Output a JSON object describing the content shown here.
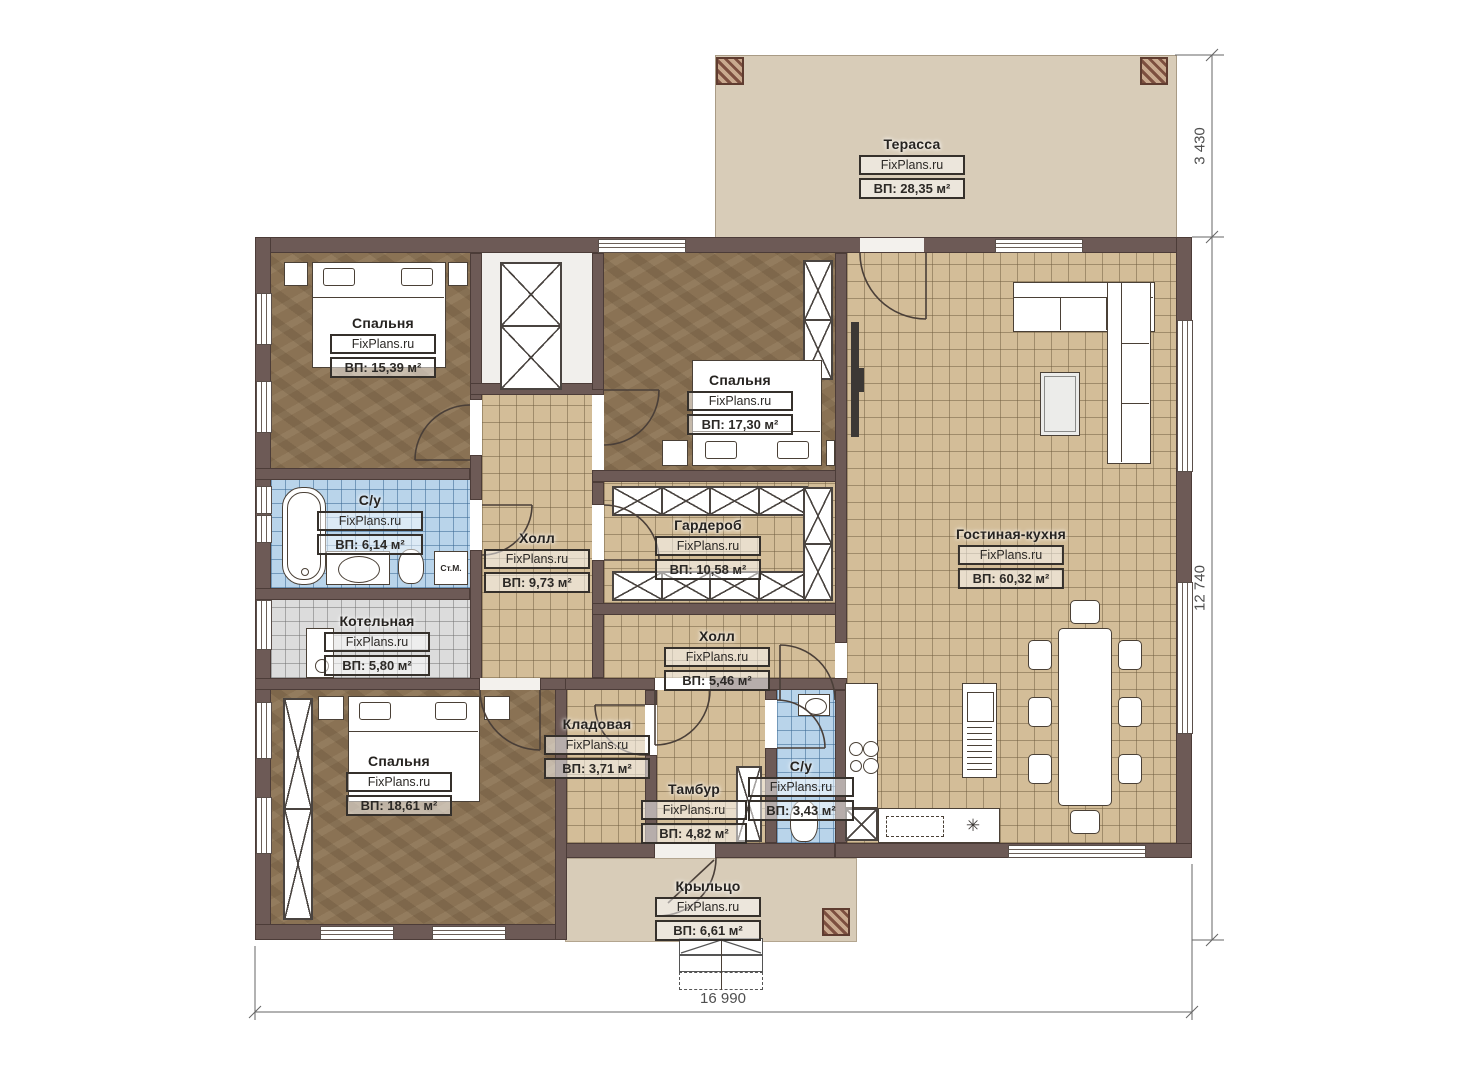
{
  "brand": "FixPlans.ru",
  "rooms": [
    {
      "id": "terrace",
      "name": "Терасса",
      "area": "ВП: 28,35 м²"
    },
    {
      "id": "bedroom-1",
      "name": "Спальня",
      "area": "ВП: 15,39 м²"
    },
    {
      "id": "bedroom-2",
      "name": "Спальня",
      "area": "ВП: 17,30 м²"
    },
    {
      "id": "bathroom-1",
      "name": "С/у",
      "area": "ВП: 6,14 м²"
    },
    {
      "id": "hall-1",
      "name": "Холл",
      "area": "ВП: 9,73 м²"
    },
    {
      "id": "wardrobe",
      "name": "Гардероб",
      "area": "ВП: 10,58 м²"
    },
    {
      "id": "living-kitchen",
      "name": "Гостиная-кухня",
      "area": "ВП: 60,32 м²"
    },
    {
      "id": "boiler-room",
      "name": "Котельная",
      "area": "ВП: 5,80 м²"
    },
    {
      "id": "hall-2",
      "name": "Холл",
      "area": "ВП: 5,46 м²"
    },
    {
      "id": "storage",
      "name": "Кладовая",
      "area": "ВП: 3,71 м²"
    },
    {
      "id": "bedroom-3",
      "name": "Спальня",
      "area": "ВП: 18,61 м²"
    },
    {
      "id": "vestibule",
      "name": "Тамбур",
      "area": "ВП: 4,82 м²"
    },
    {
      "id": "bathroom-2",
      "name": "С/у",
      "area": "ВП: 3,43 м²"
    },
    {
      "id": "porch",
      "name": "Крыльцо",
      "area": "ВП: 6,61 м²"
    }
  ],
  "annotations": {
    "washing_machine": "Ст.М."
  },
  "icons": {
    "kitchen_sink": "✳"
  },
  "dimensions": {
    "terrace_depth": "3 430",
    "house_depth": "12 740",
    "house_width": "16 990"
  },
  "colors": {
    "wall": "#6d5a56",
    "tile_tan": "#d3bd98",
    "tile_blue": "#b9d4ea",
    "tile_gray": "#dcdcdc",
    "floor_brown": "#8a7254",
    "terrace_beige": "#d8ccb8"
  }
}
